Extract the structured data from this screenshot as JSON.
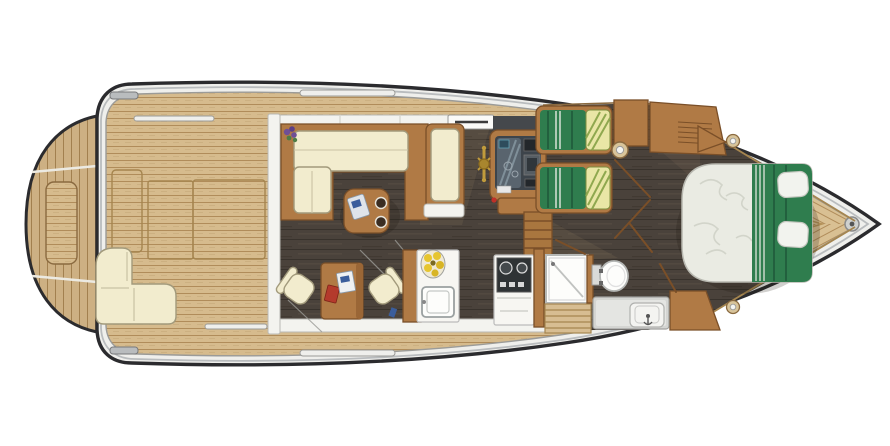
{
  "scene": {
    "name": "motor-yacht-floor-plan",
    "view": "top-down",
    "bow_direction": "right",
    "stern_direction": "left"
  },
  "palette": {
    "hull_outline": "#2b2b2e",
    "rub_rail": "#b9bcbe",
    "gunwale": "#efefec",
    "teak": "#d6bb8d",
    "teak_gap": "#b08c5a",
    "teak_dark": "#a5854f",
    "platform_teak": "#cdb083",
    "platform_gap": "#a2804f",
    "wood": "#b07a45",
    "wood_dark": "#7a4f28",
    "wood_light": "#c79454",
    "floor": "#4a423b",
    "floor_gap": "#38322c",
    "cream": "#f2ecce",
    "cream_edge": "#a29a7c",
    "green": "#2f7d4e",
    "green_dark": "#20593a",
    "green_stripe": "#e3e8e0",
    "pillow_yellow": "#e9e6a6",
    "pillow_stripe": "#8fa84f",
    "duvet": "#eaebe3",
    "duvet_line": "#cfd1c6",
    "fixture": "#fdfdfb",
    "fixture_edge": "#b4b6b4",
    "fixture_gray": "#d6d7d4",
    "white_band": "#f3f3ef",
    "band_edge": "#b9b9b4",
    "dash": "#3d444b",
    "dash_light": "#59646e",
    "screen_blue": "#2e4c5c",
    "gold": "#c09b3c",
    "flower_yellow": "#e6c52f",
    "flower_purple": "#6f4f96",
    "leaf_green": "#4e7d46",
    "book_red": "#b43a2c",
    "card_blue": "#3a5d9c"
  },
  "areas": [
    {
      "id": "swim-platform",
      "items": [
        "teak-planks",
        "platform-step-box"
      ]
    },
    {
      "id": "aft-deck-cockpit",
      "items": [
        "stern-bench",
        "engine-hatch",
        "deck-rails",
        "stern-cleats"
      ]
    },
    {
      "id": "salon",
      "items": [
        "l-shaped-sofa",
        "coffee-table",
        "chaise-lounge",
        "flower-pot"
      ]
    },
    {
      "id": "helm-station",
      "items": [
        "helm-console",
        "instrument-panel",
        "steering-wheel",
        "companionway-stairs",
        "sliding-door"
      ]
    },
    {
      "id": "galley",
      "items": [
        "dinette-table",
        "dinette-chair-left",
        "dinette-chair-right",
        "sink-unit",
        "flower-bowl",
        "stove-unit"
      ]
    },
    {
      "id": "guest-cabin",
      "items": [
        "twin-berth-upper",
        "twin-berth-lower",
        "wardrobe",
        "side-cabinet",
        "portholes"
      ]
    },
    {
      "id": "head",
      "items": [
        "shower",
        "toilet",
        "vanity-sink",
        "steps-down"
      ]
    },
    {
      "id": "owner-cabin",
      "items": [
        "island-double-bed",
        "bed-pillows",
        "bow-cabinet"
      ]
    },
    {
      "id": "foredeck",
      "items": [
        "v-teak-planking",
        "bow-deck-fitting",
        "anchor-locker-chevrons"
      ]
    }
  ],
  "bedding": {
    "twin_berths": {
      "duvet_color": "#2f7d4e",
      "pillow_style": "yellow-green-striped"
    },
    "owner_bed": {
      "duvet_color": "#eaebe3",
      "runner_color": "#2f7d4e",
      "pillows": 2
    }
  }
}
